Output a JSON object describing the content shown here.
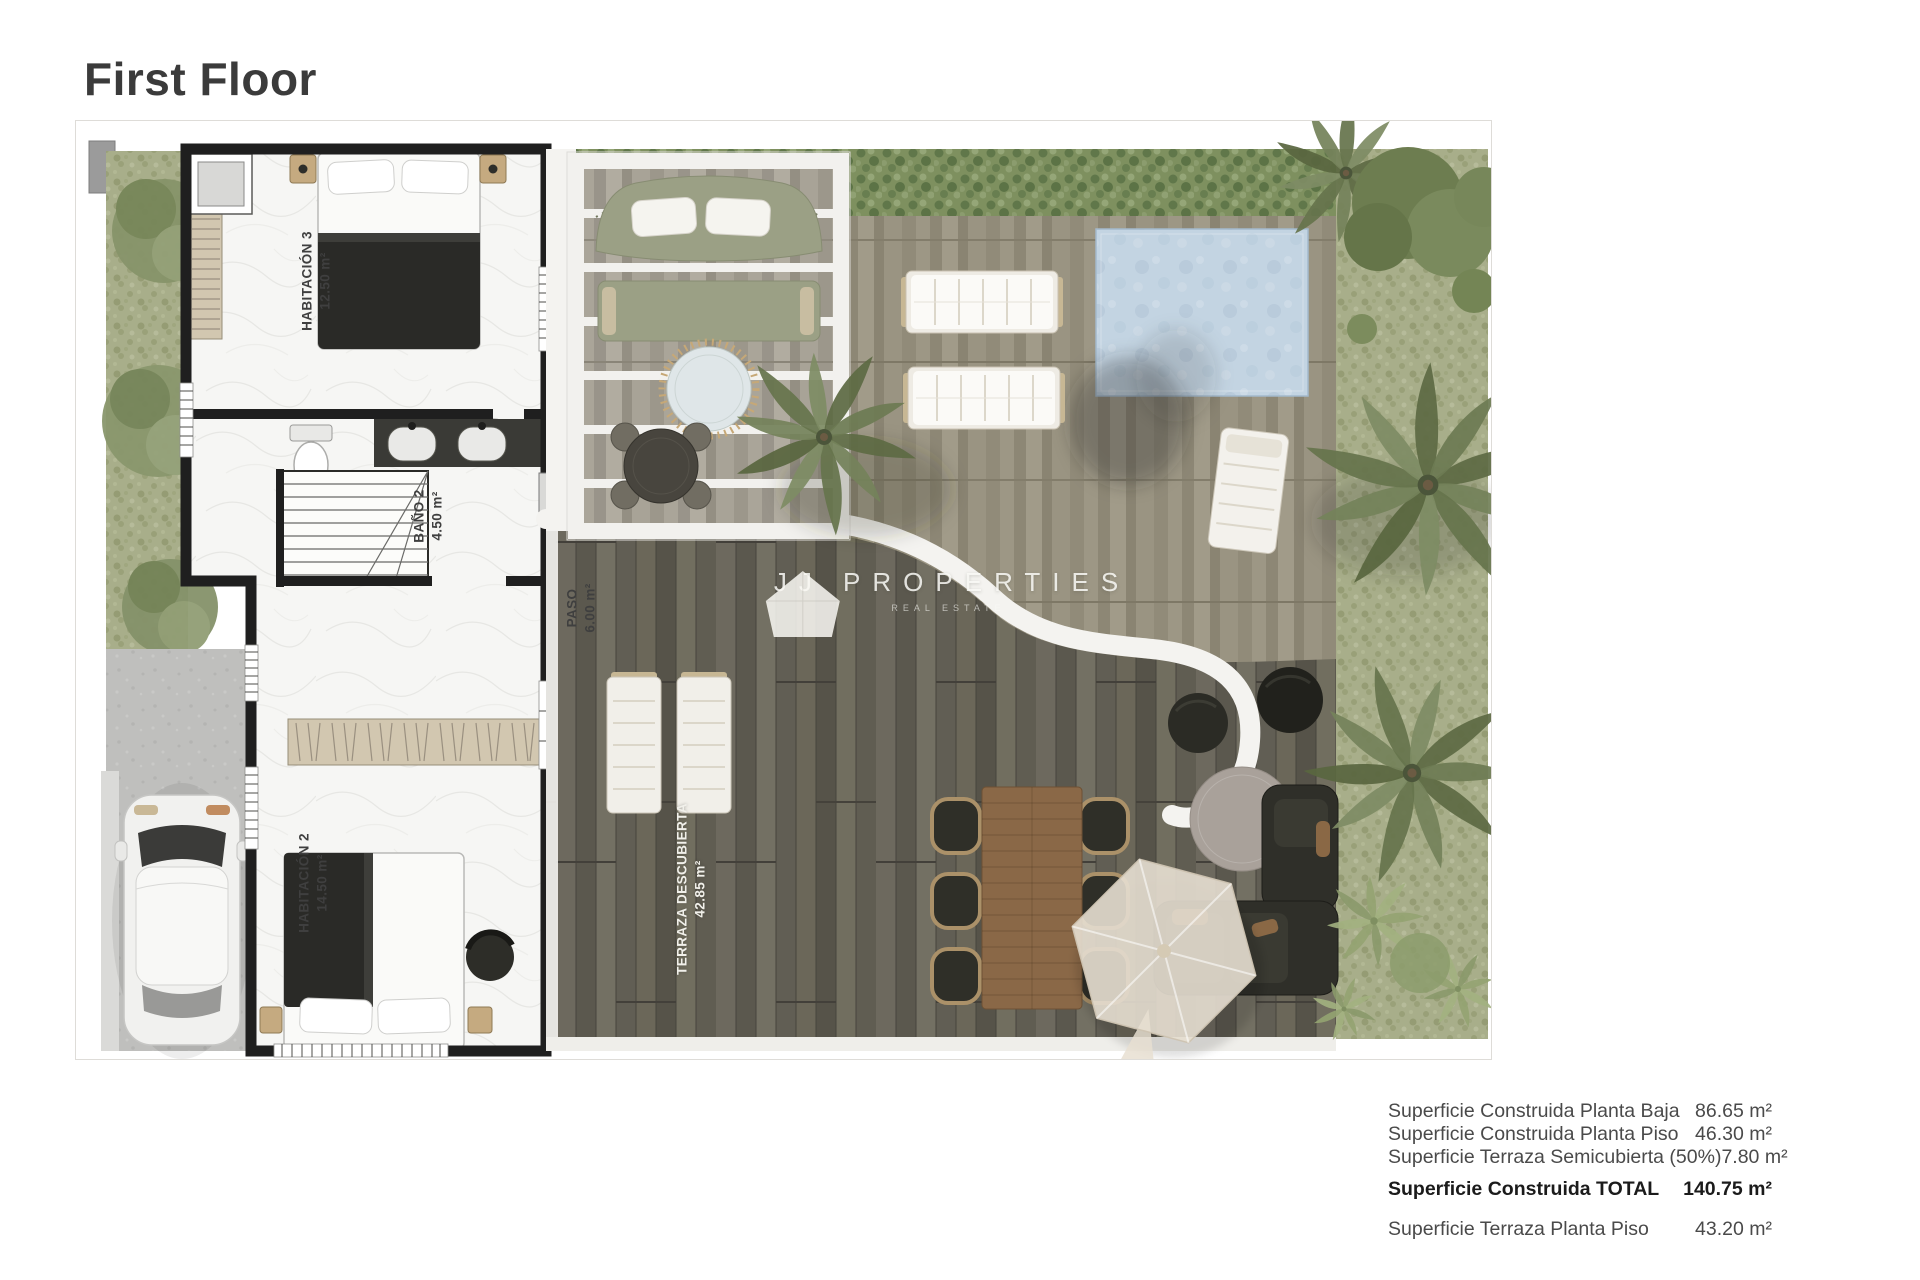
{
  "title": "First Floor",
  "rooms": [
    {
      "name": "HABITACIÓN 3",
      "area": "12.50 m²"
    },
    {
      "name": "BAÑO 2",
      "area": "4.50 m²"
    },
    {
      "name": "PASO",
      "area": "6.00 m²"
    },
    {
      "name": "HABITACIÓN 2",
      "area": "14.50 m²"
    },
    {
      "name": "TERRAZA DESCUBIERTA",
      "area": "42.85 m²"
    }
  ],
  "watermark": {
    "brand": "JJ PROPERTIES",
    "tagline": "REAL ESTATE"
  },
  "area_table": {
    "rows": [
      {
        "label": "Superficie Construida Planta Baja",
        "value": "86.65 m²"
      },
      {
        "label": "Superficie Construida Planta Piso",
        "value": "46.30 m²"
      },
      {
        "label": "Superficie Terraza Semicubierta (50%)",
        "value": "7.80 m²"
      },
      {
        "label": "Superficie Construida TOTAL",
        "value": "140.75 m²"
      },
      {
        "label": "Superficie Terraza Planta Piso",
        "value": "43.20 m²"
      }
    ]
  },
  "colors": {
    "wall": "#1f1f1f",
    "pool_water": "#c3d4e2",
    "deck_wood": "#666258",
    "patio_stone": "#97917f",
    "grass": "#a8ae8a",
    "hedge": "#7e905f",
    "title_text": "#3b3b3b"
  }
}
